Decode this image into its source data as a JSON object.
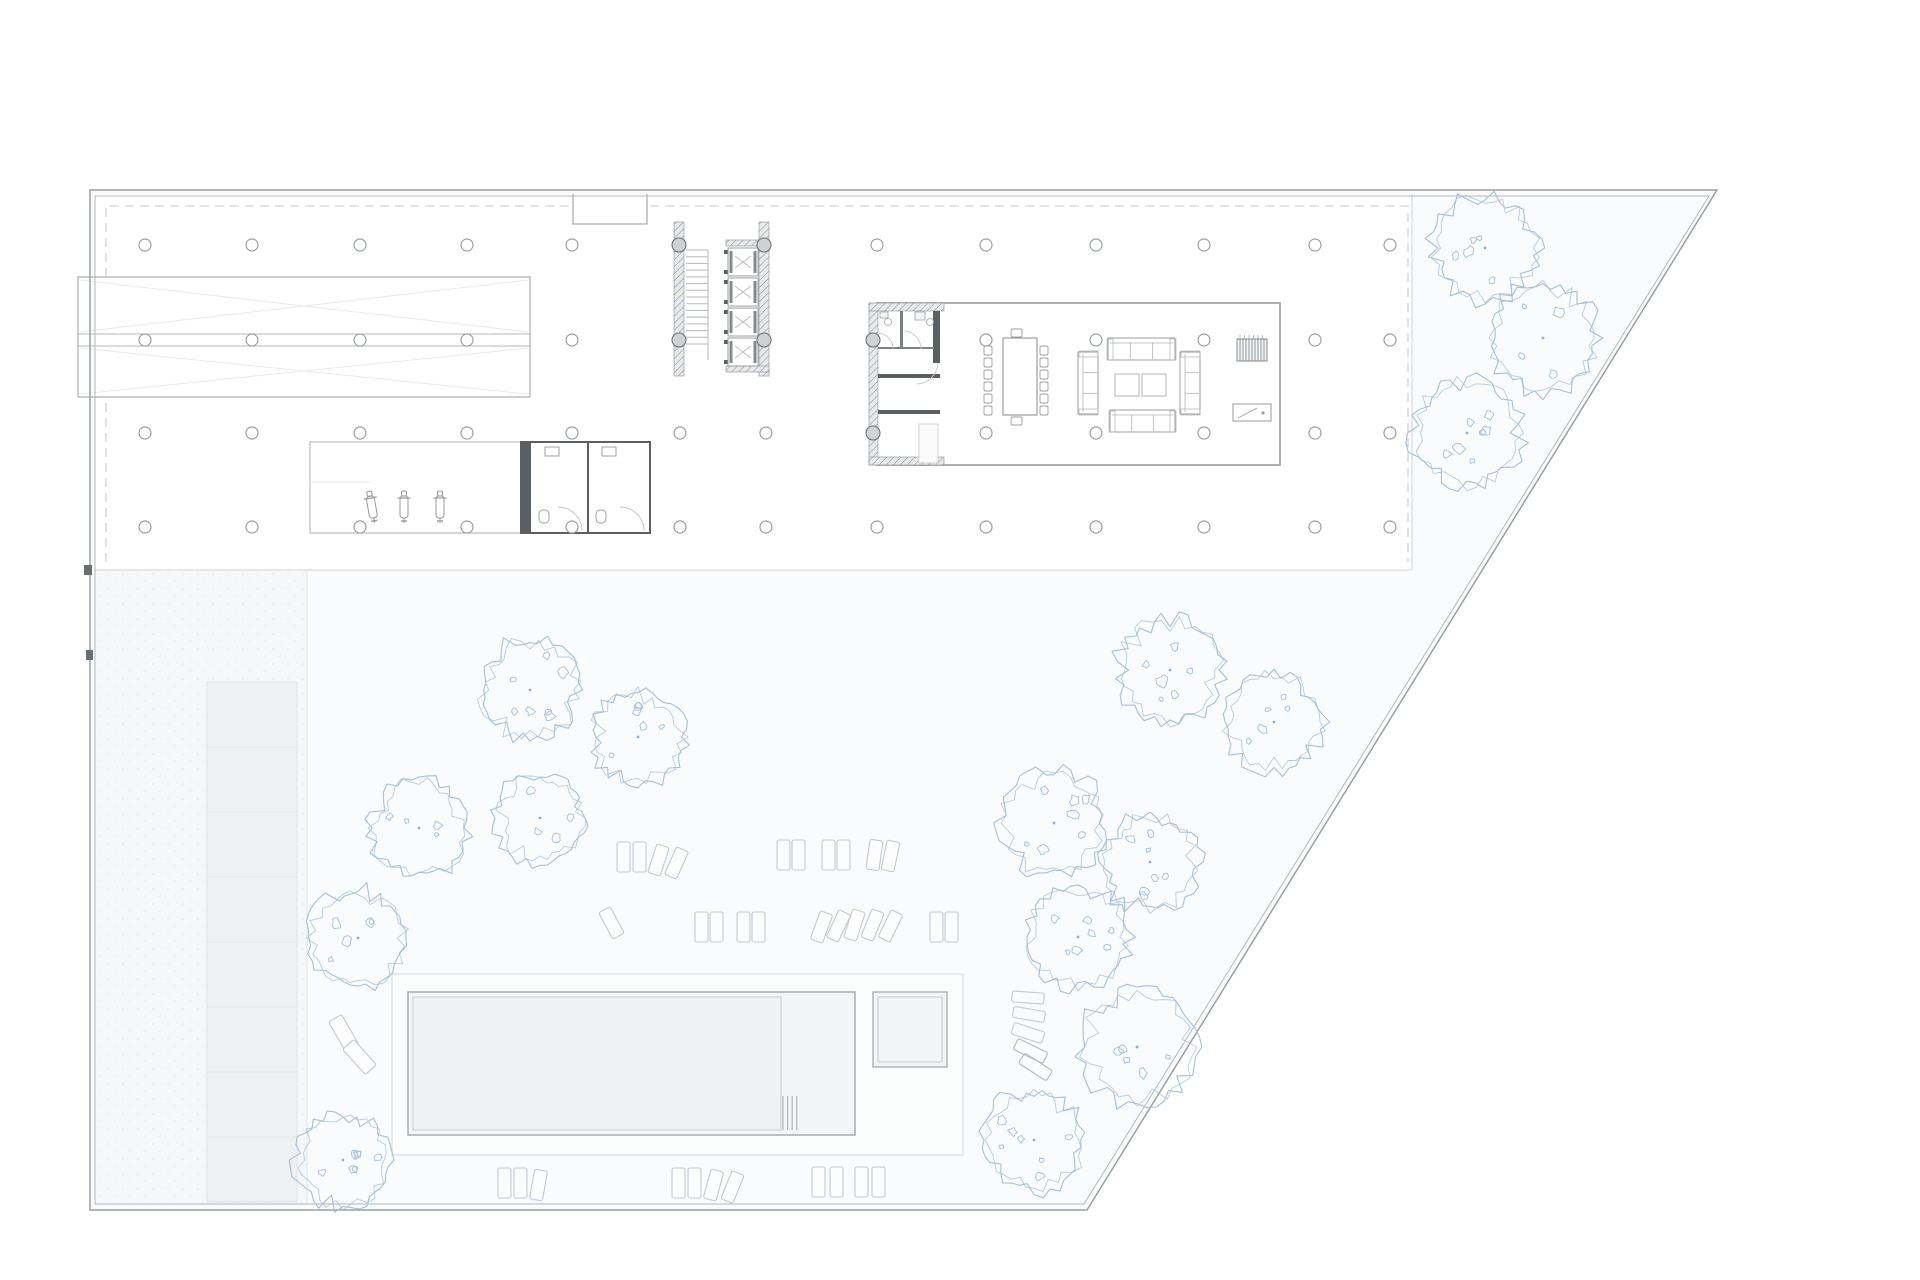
{
  "page": {
    "bg": "#ffffff"
  },
  "palette": {
    "boundary": "#9aa0a3",
    "boundary_inner": "#b4b8ba",
    "line_light": "#c9ccce",
    "line_faint": "#e9eaeb",
    "slab_edge": "#d8dadb",
    "dashed": "#c6c9cb",
    "wall_dark": "#5b5f62",
    "hatch_line": "#8e9294",
    "hatch_bg": "#e8e9ea",
    "furniture": "#9aa0a3",
    "furniture_light": "#b6babd",
    "column": "#9aa0a3",
    "column_fill": "#cfd2d4",
    "tree": "#a6bfd8",
    "tree_dot": "#8fafcf",
    "lawn": "#fafbfc",
    "building": "#ffffff",
    "deck_line": "#dcdee0",
    "deck_fill": "#fbfcfc",
    "pool_line": "#a8acae",
    "pool_fill": "#f3f4f5",
    "water_line": "#c6c9cb",
    "water_fill": "#f0f1f2",
    "pave_fill": "#eff0f1",
    "pave_line": "#e3e4e6",
    "strip_fill": "#f6f7f8",
    "sunbed": "#c3c9cf",
    "sunbed_dark": "#b2b9c0"
  },
  "site": {
    "outline": [
      [
        90,
        190
      ],
      [
        1717,
        190
      ],
      [
        1087,
        1210
      ],
      [
        90,
        1210
      ]
    ],
    "inner": [
      [
        95,
        196
      ],
      [
        1709,
        196
      ],
      [
        1084,
        1204
      ],
      [
        95,
        1204
      ]
    ]
  },
  "building": {
    "floor": [
      94,
      194,
      1318,
      376
    ],
    "bottom_y": 570,
    "right_x": 1412,
    "dashed_path": "M106,562 L106,206 L1408,206 L1408,562",
    "notch": [
      573,
      194,
      74,
      30
    ],
    "edge_ticks": [
      [
        84,
        565,
        8,
        10
      ],
      [
        86,
        650,
        7,
        10
      ]
    ]
  },
  "grid": {
    "radius": 6,
    "rows": {
      "245": [
        145,
        252,
        360,
        467,
        572,
        877,
        986,
        1096,
        1204,
        1315,
        1390
      ],
      "340": [
        145,
        252,
        360,
        467,
        572,
        986,
        1096,
        1204,
        1315,
        1390
      ],
      "433": [
        145,
        252,
        360,
        467,
        572,
        680,
        766,
        986,
        1096,
        1204,
        1315,
        1390
      ],
      "527": [
        145,
        252,
        360,
        467,
        572,
        680,
        766,
        877,
        986,
        1096,
        1204,
        1315,
        1390
      ]
    },
    "wall_columns": [
      [
        679,
        245
      ],
      [
        764,
        245
      ],
      [
        679,
        340
      ],
      [
        764,
        340
      ],
      [
        873,
        340
      ],
      [
        873,
        433
      ]
    ],
    "wall_col_radius": 7
  },
  "ramp": {
    "box": [
      78,
      277,
      452,
      120
    ],
    "mid_lines": [
      334,
      346
    ],
    "x0": 80,
    "x1": 528,
    "top": 280,
    "bottom": 394
  },
  "core": {
    "walls": [
      [
        674,
        222,
        10,
        154
      ],
      [
        759,
        222,
        10,
        154
      ]
    ],
    "caps": [
      [
        726,
        240,
        43,
        6
      ],
      [
        726,
        366,
        43,
        6
      ]
    ],
    "stair": {
      "x": 686,
      "w": 22,
      "y0": 250,
      "y1": 344,
      "treads": 14,
      "stringer_x": 708,
      "stringer_y1": 360
    },
    "elevators": {
      "x": 728,
      "w": 30,
      "ys": [
        248,
        278,
        308,
        338
      ],
      "h": 28
    }
  },
  "garage": {
    "room": [
      310,
      442,
      211,
      91
    ],
    "inner_line_y": 482,
    "scooters": [
      [
        372,
        492,
        -10
      ],
      [
        404,
        492,
        0
      ],
      [
        440,
        492,
        0
      ]
    ]
  },
  "wc_block_a": {
    "rect": [
      521,
      442,
      129,
      91
    ],
    "left_bar": [
      521,
      442,
      10,
      91
    ],
    "partition_x": 588,
    "rooms": [
      [
        531,
        442,
        57,
        91
      ],
      [
        588,
        442,
        62,
        91
      ]
    ]
  },
  "big_room": {
    "rect": [
      877,
      303,
      403,
      162
    ],
    "hatch": [
      [
        869,
        303,
        9,
        162
      ],
      [
        869,
        303,
        75,
        8
      ],
      [
        869,
        457,
        75,
        8
      ]
    ],
    "dark_walls": [
      [
        933,
        311,
        7,
        52
      ],
      [
        878,
        374,
        62,
        4
      ],
      [
        878,
        410,
        62,
        4
      ]
    ],
    "partitions": [
      [
        900,
        311,
        3,
        38
      ],
      [
        878,
        347,
        22,
        2
      ],
      [
        903,
        347,
        31,
        2
      ]
    ],
    "door_arcs": [
      "M893,348 A16,16 0 0 0 879,333",
      "M921,349 A18,18 0 0 0 905,331",
      "M938,363 A22,22 0 0 1 917,384"
    ],
    "counter": [
      919,
      424,
      19,
      39
    ],
    "fixtures": {
      "sinks": [
        [
          880,
          312,
          8,
          6
        ],
        [
          915,
          312,
          10,
          8
        ]
      ],
      "basins": [
        [
          888,
          322,
          3.5
        ],
        [
          930,
          322,
          3.5
        ]
      ]
    },
    "table": {
      "rect": [
        1003,
        338,
        34,
        77
      ],
      "chair_ys": [
        346,
        358,
        370,
        382,
        394,
        406
      ],
      "left_x": 992,
      "right_x": 1040,
      "top": [
        1011,
        329,
        11,
        8
      ],
      "bottom": [
        1011,
        417,
        11,
        8
      ]
    },
    "sofas": {
      "top": [
        1108,
        338,
        67,
        22
      ],
      "bottom": [
        1110,
        410,
        65,
        22
      ],
      "left": [
        1078,
        352,
        20,
        62
      ],
      "right": [
        1180,
        352,
        20,
        62
      ],
      "tables": [
        [
          1115,
          374,
          24,
          22
        ],
        [
          1142,
          374,
          24,
          22
        ]
      ]
    },
    "piano": [
      1237,
      339,
      30,
      22
    ],
    "desk": [
      1233,
      404,
      38,
      17
    ]
  },
  "pool_area": {
    "deck": [
      392,
      974,
      571,
      181
    ],
    "pool": [
      408,
      992,
      447,
      143
    ],
    "water": [
      413,
      997,
      368,
      133
    ],
    "ladder": {
      "x0": 783,
      "step": 4.6,
      "n": 4,
      "y0": 1096,
      "y1": 1130
    },
    "spa": [
      873,
      992,
      74,
      75
    ],
    "spa_inner": [
      878,
      997,
      64,
      65
    ]
  },
  "landscape": {
    "strip": {
      "rect": [
        95,
        570,
        212,
        636
      ],
      "divider_x": 307,
      "pave": [
        207,
        682,
        90,
        520
      ],
      "cells": 8
    },
    "benches": [
      [
        336,
        1016,
        15,
        34,
        -30
      ],
      [
        352,
        1040,
        15,
        34,
        -42
      ]
    ],
    "stack_chairs": [
      [
        1012,
        992,
        32,
        11,
        4
      ],
      [
        1013,
        1009,
        32,
        11,
        10
      ],
      [
        1012,
        1027,
        32,
        12,
        18
      ],
      [
        1014,
        1045,
        33,
        12,
        26
      ],
      [
        1019,
        1061,
        33,
        12,
        33
      ]
    ],
    "sunbed_size": [
      13,
      30
    ],
    "sunbeds": [
      [
        617,
        842,
        0
      ],
      [
        633,
        842,
        0
      ],
      [
        652,
        845,
        18
      ],
      [
        670,
        848,
        24
      ],
      [
        777,
        840,
        0
      ],
      [
        792,
        840,
        0
      ],
      [
        822,
        840,
        0
      ],
      [
        837,
        840,
        0
      ],
      [
        868,
        840,
        8
      ],
      [
        884,
        841,
        12
      ],
      [
        605,
        908,
        -28
      ],
      [
        695,
        912,
        0
      ],
      [
        710,
        912,
        0
      ],
      [
        737,
        912,
        0
      ],
      [
        752,
        912,
        0
      ],
      [
        815,
        912,
        20
      ],
      [
        832,
        911,
        25
      ],
      [
        848,
        910,
        18
      ],
      [
        866,
        910,
        22
      ],
      [
        884,
        911,
        26
      ],
      [
        930,
        912,
        0
      ],
      [
        945,
        912,
        0
      ],
      [
        498,
        1168,
        0
      ],
      [
        514,
        1168,
        0
      ],
      [
        532,
        1170,
        10
      ],
      [
        672,
        1168,
        0
      ],
      [
        688,
        1168,
        0
      ],
      [
        707,
        1170,
        15
      ],
      [
        726,
        1172,
        22
      ],
      [
        812,
        1167,
        0
      ],
      [
        830,
        1167,
        0
      ],
      [
        855,
        1167,
        0
      ],
      [
        872,
        1167,
        0
      ]
    ],
    "trees": [
      [
        530,
        690,
        52
      ],
      [
        638,
        737,
        48
      ],
      [
        419,
        828,
        50
      ],
      [
        540,
        818,
        46
      ],
      [
        358,
        938,
        50
      ],
      [
        343,
        1160,
        48
      ],
      [
        1170,
        670,
        54
      ],
      [
        1274,
        722,
        50
      ],
      [
        1054,
        823,
        54
      ],
      [
        1150,
        862,
        50
      ],
      [
        1078,
        937,
        52
      ],
      [
        1137,
        1047,
        58
      ],
      [
        1034,
        1140,
        52
      ],
      [
        1485,
        248,
        55
      ],
      [
        1543,
        338,
        55
      ],
      [
        1467,
        433,
        55
      ]
    ]
  }
}
